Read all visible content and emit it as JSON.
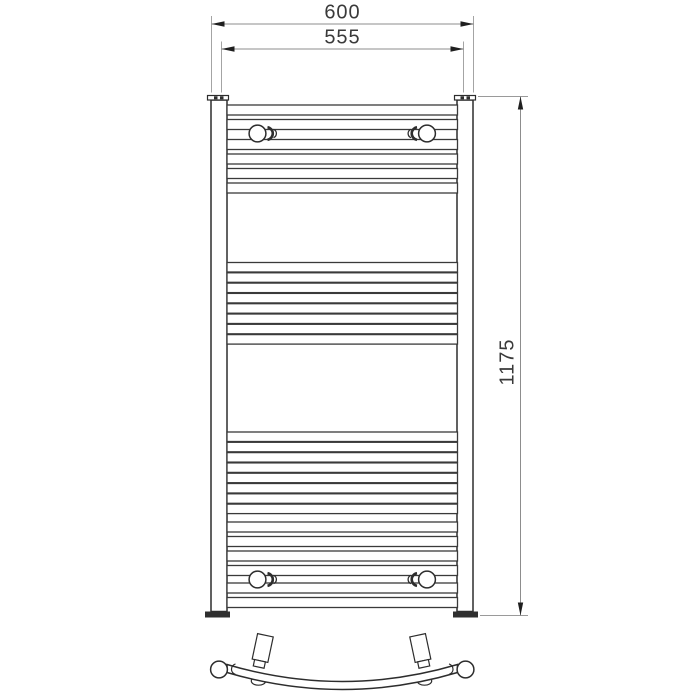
{
  "colors": {
    "background": "#ffffff",
    "object_line": "#2d2d2d",
    "dimension_line": "#8d8d8d",
    "dimension_text": "#3a3a3a"
  },
  "dimensions": {
    "overall_width": "600",
    "bracket_centres_width": "555",
    "overall_height": "1175"
  }
}
